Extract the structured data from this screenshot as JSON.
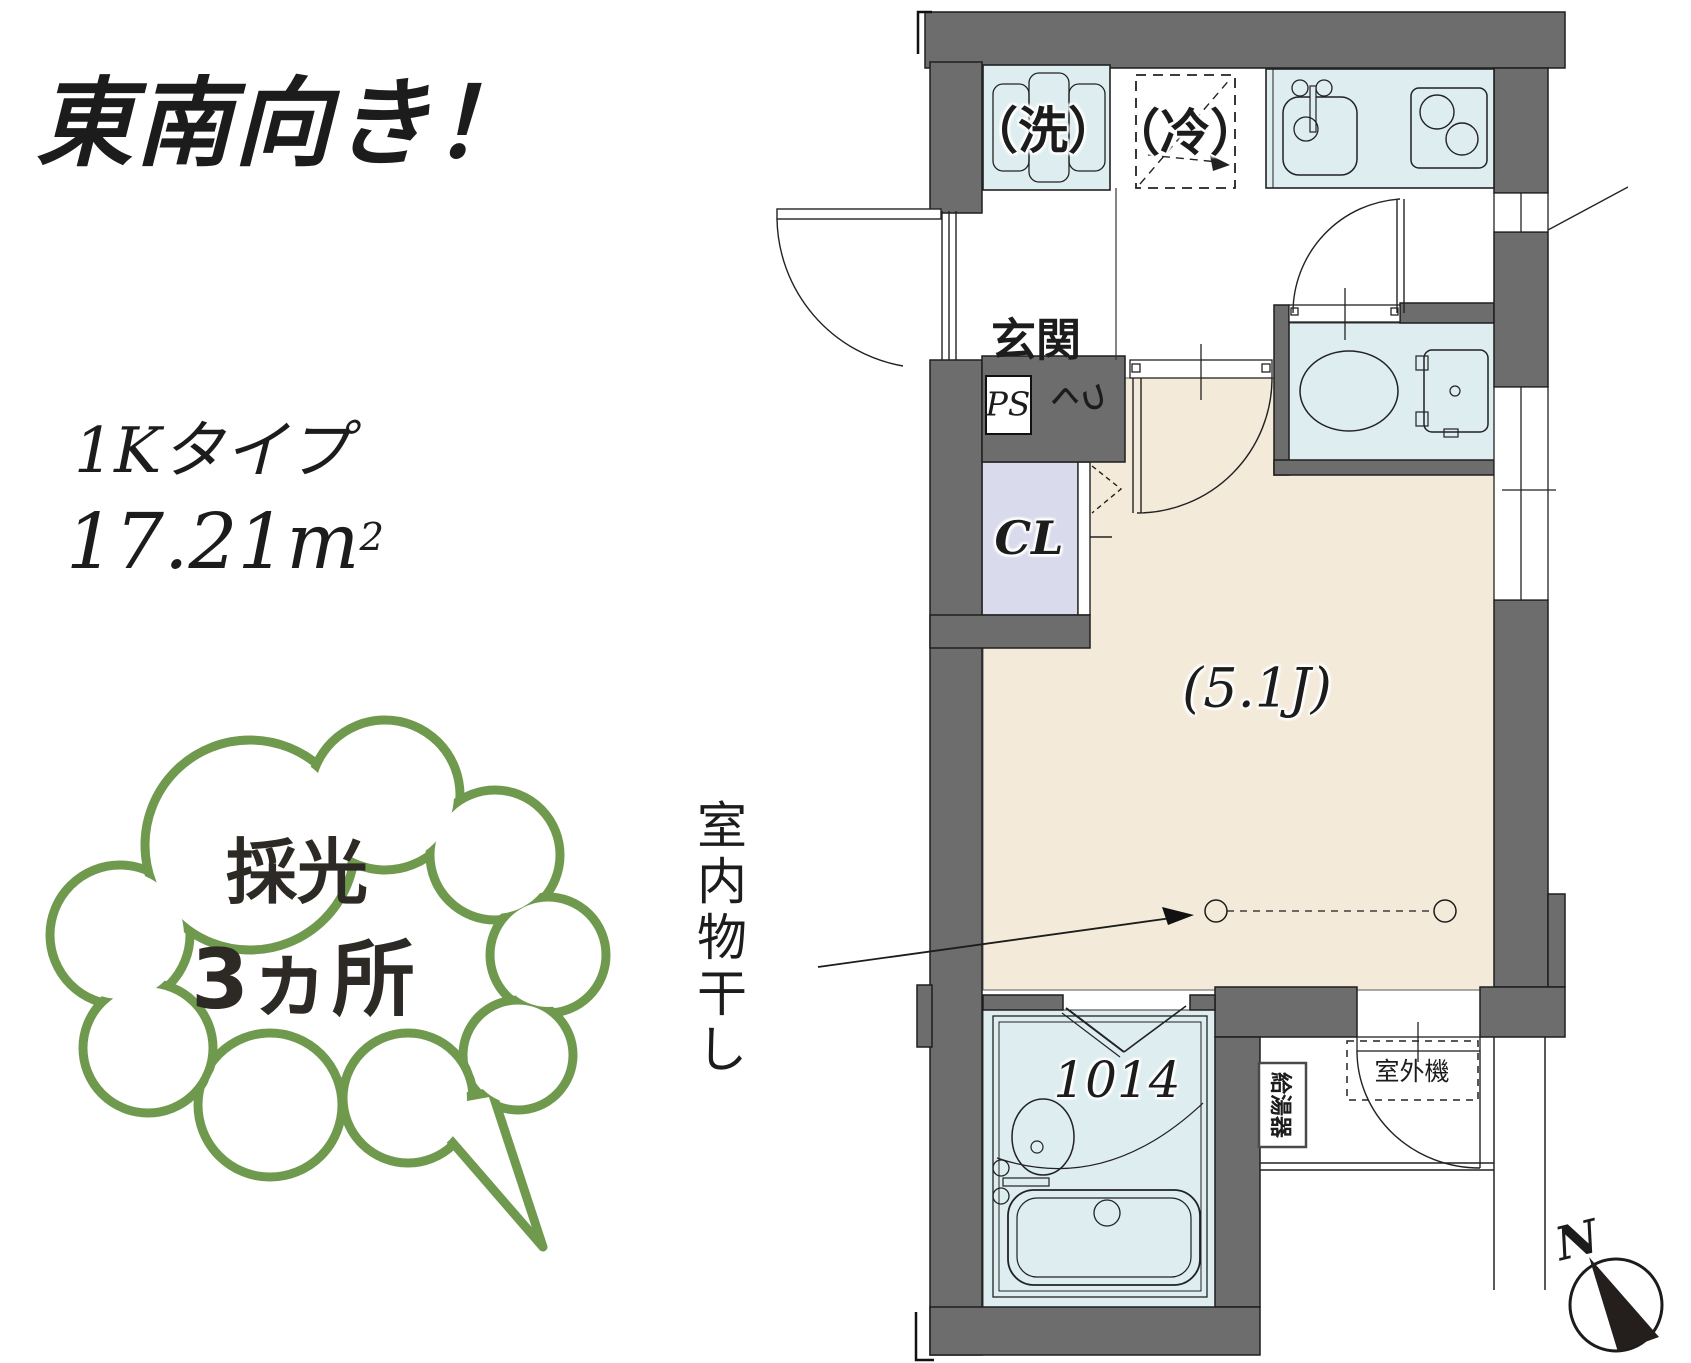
{
  "headline": {
    "text": "東南向き！"
  },
  "specs": {
    "type": "1Kタイプ",
    "area": "17.21m",
    "area_sup": "2"
  },
  "badge": {
    "line1": "採光",
    "line2": "3ヵ所"
  },
  "plan": {
    "washer": "（洗）",
    "fridge": "（冷）",
    "entrance": "玄関",
    "pipe_space": "PS",
    "shoes_c1": "く",
    "shoes_c2": "つ",
    "closet": "CL",
    "room_size": "(5.1J)",
    "drying": "室内物干し",
    "bath_size": "1014",
    "water_heater": "給湯器",
    "outdoor_unit": "室外機",
    "north": "N"
  },
  "colors": {
    "wall_gray": "#6d6d6d",
    "fixture_blue": "#ddedf0",
    "storage_lavender": "#d9daeb",
    "room_beige": "#f3ead9",
    "badge_green": "#6f9a4e",
    "ink": "#1c1c1c"
  }
}
